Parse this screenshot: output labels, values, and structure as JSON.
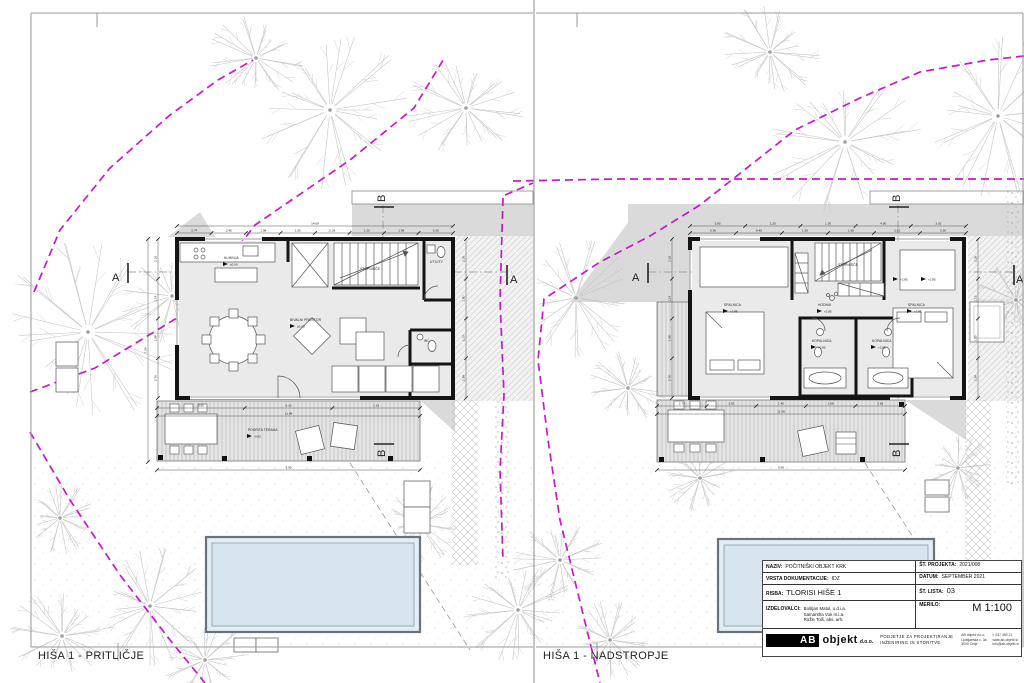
{
  "panels": [
    {
      "caption": "HIŠA 1 - PRITLIČJE",
      "markers": {
        "a": "A",
        "b": "B"
      },
      "rooms": {
        "kitchen": "KUHINJA",
        "kitchen_level": "±0.00",
        "stairs": "STOPNIŠČE",
        "living": "BIVALNI PROSTOR",
        "living_level": "±0.00",
        "utility": "UTILITY",
        "wc": "WC",
        "terrace": "POKRITA TERASA",
        "terrace_level": "-0.02"
      },
      "dims": {
        "top_total": [
          "14.00"
        ],
        "top": [
          "2.74",
          "2.45",
          "1.98",
          "1.00",
          "2.24",
          "1.20",
          "1.98",
          "0.36"
        ],
        "left_side": [
          "2.16",
          "1.14",
          "1.98",
          "2.76"
        ],
        "far_left": [
          "7.26"
        ],
        "right_side": [
          "2.26",
          "1.50",
          "1.13",
          "2.38"
        ],
        "bottom": [
          "3.55",
          "6.13",
          "1.15"
        ],
        "bottom_total": [
          "11.98"
        ],
        "ground_total": [
          "9.90"
        ]
      }
    },
    {
      "caption": "HIŠA 1 - NADSTROPJE",
      "markers": {
        "a": "A",
        "b": "B"
      },
      "rooms": {
        "bedroom_left": "SPALNICA",
        "bedroom_left_level": "+2.85",
        "bedroom_right": "SPALNICA",
        "bedroom_right_level": "+2.85",
        "hall": "HODNIK",
        "hall_level": "+2.85",
        "bath_left": "KOPALNICA",
        "bath_left_level": "+2.85",
        "bath_right": "KOPALNICA",
        "bath_right_level": "+2.85",
        "stairs": "STOPNIŠČE",
        "aux_level": "+2.85"
      },
      "dims": {
        "top": [
          "3.85",
          "1.20",
          "1.50",
          "4.90",
          "3.03"
        ],
        "top2": [
          "0.36",
          "8.45",
          "1.60",
          "1.50",
          "3.63",
          "0.36"
        ],
        "left_side": [
          "2.16",
          "1.14",
          "1.98",
          "2.76"
        ],
        "right_side": [
          "2.26",
          "1.13",
          "1.50",
          "2.38"
        ],
        "bottom": [
          "2.74",
          "3.82",
          "1.40",
          "1.98",
          "3.63"
        ],
        "bottom_total": [
          "11.98"
        ],
        "ground_total": [
          "9.90"
        ]
      }
    }
  ],
  "title_block": {
    "naziv_label": "NAZIV:",
    "naziv": "POČITNIŠKI OBJEKT KRK",
    "st_projekta_label": "ŠT. PROJEKTA:",
    "st_projekta": "2021/008",
    "vrsta_label": "VRSTA DOKUMENTACIJE:",
    "vrsta": "IDZ",
    "datum_label": "DATUM:",
    "datum": "SEPTEMBER 2021",
    "risba_label": "RISBA:",
    "risba": "TLORISI HIŠE 1",
    "st_lista_label": "ŠT. LISTA:",
    "st_lista": "03",
    "izdelovalci_label": "IZDELOVALCI:",
    "izdelovalci": [
      "Boštjan Matul, u.d.i.a.",
      "Samantha Vuk m.i.a.",
      "Rožle Tolš, abs. arh."
    ],
    "merilo_label": "MERILO:",
    "merilo": "M 1:100",
    "logo_ab": "AB",
    "logo_rest": "objekt",
    "logo_suffix": "d.o.o.",
    "company_desc1": "PODJETJE ZA PROJEKTIRANJE",
    "company_desc2": "INŽENIRING IN STORITVE",
    "contact_col1": [
      "AB objekt d.o.o.",
      "Ljubljanska c. 3a",
      "3000 Celje"
    ],
    "contact_col2": [
      "t: 047 450 21",
      "www.ab-objekt.si",
      "info@ab-objekt.si"
    ]
  }
}
